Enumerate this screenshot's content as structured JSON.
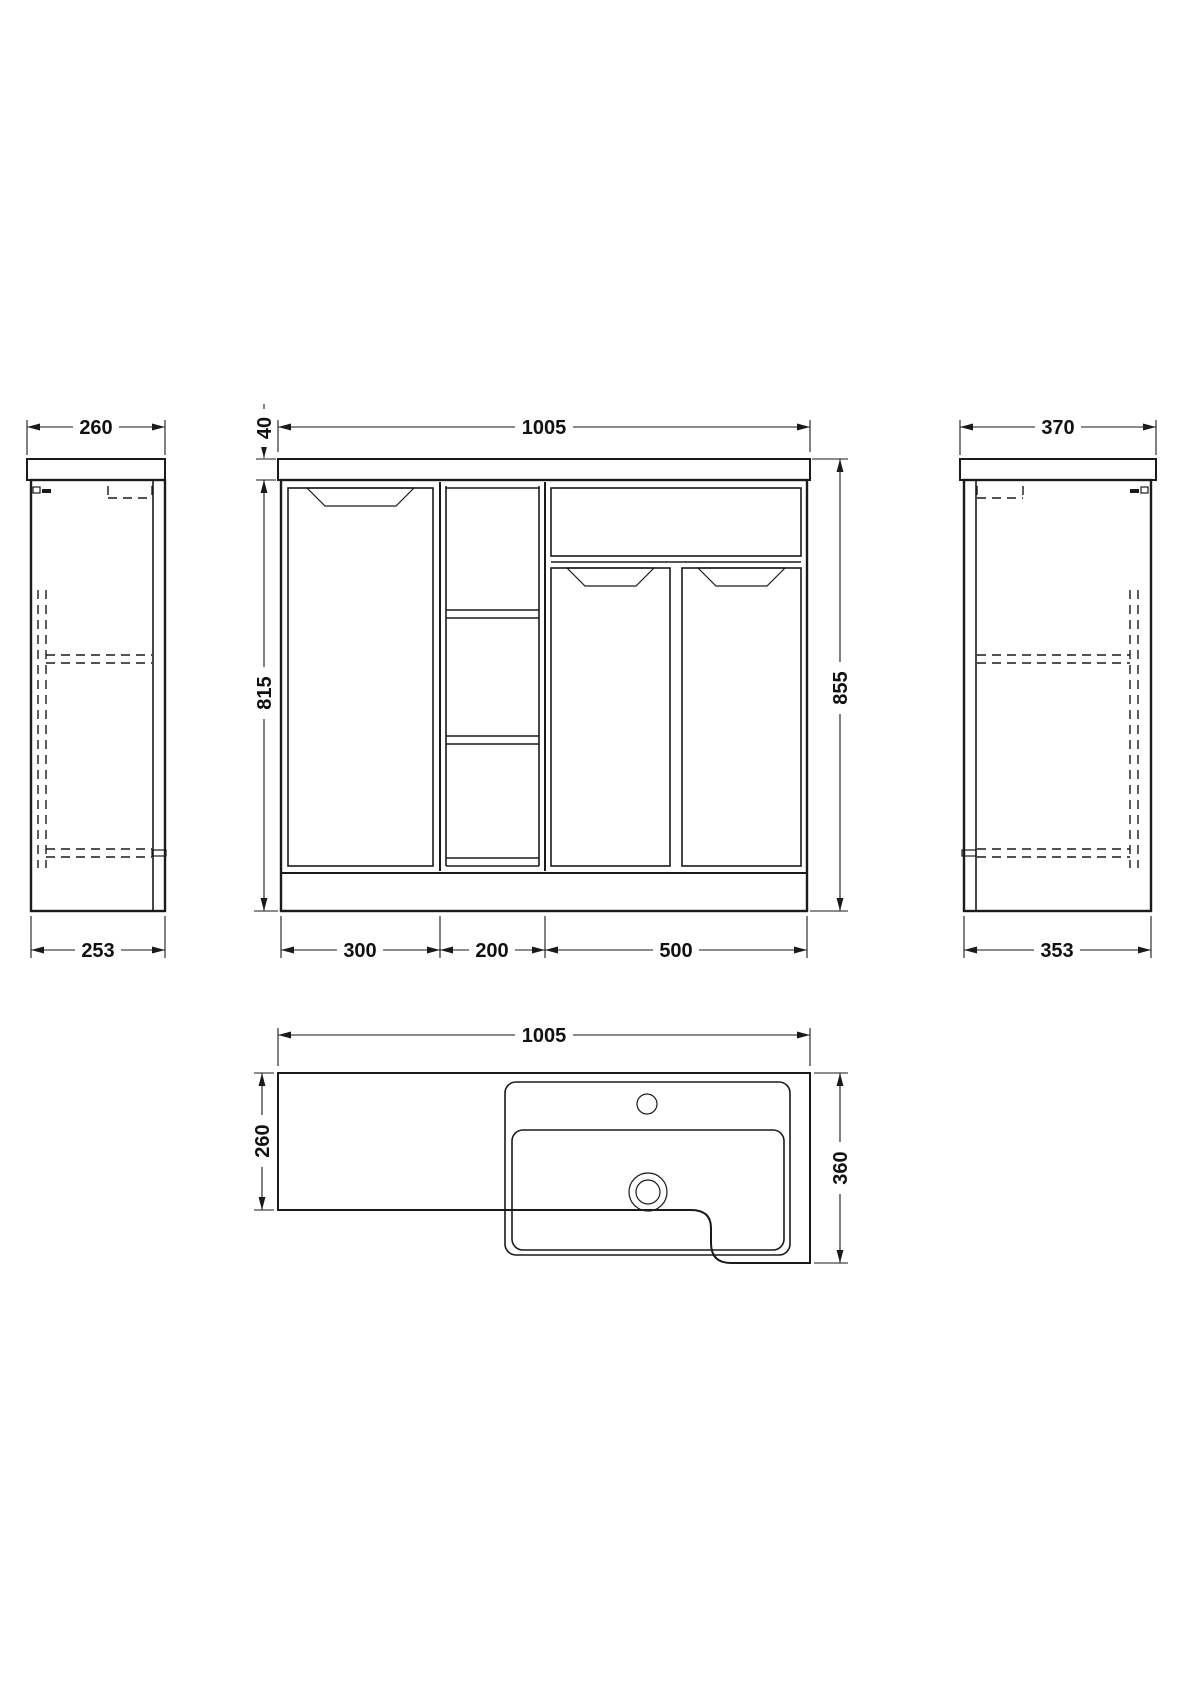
{
  "drawing": {
    "type": "technical-dimension-drawing",
    "unit_hint": "mm",
    "colors": {
      "line": "#1a1a1a",
      "background": "#ffffff"
    },
    "views": {
      "left_side": {
        "name": "left side elevation",
        "top_dim": "260",
        "bottom_dim": "253"
      },
      "front": {
        "name": "front elevation",
        "width_dim": "1005",
        "worktop_thickness_dim": "40",
        "cabinet_height_dim": "815",
        "total_height_dim": "855",
        "section_dims": [
          "300",
          "200",
          "500"
        ]
      },
      "right_side": {
        "name": "right side elevation",
        "top_dim": "370",
        "bottom_dim": "353"
      },
      "plan": {
        "name": "plan view",
        "width_dim": "1005",
        "left_depth_dim": "260",
        "right_depth_dim": "360"
      }
    }
  }
}
